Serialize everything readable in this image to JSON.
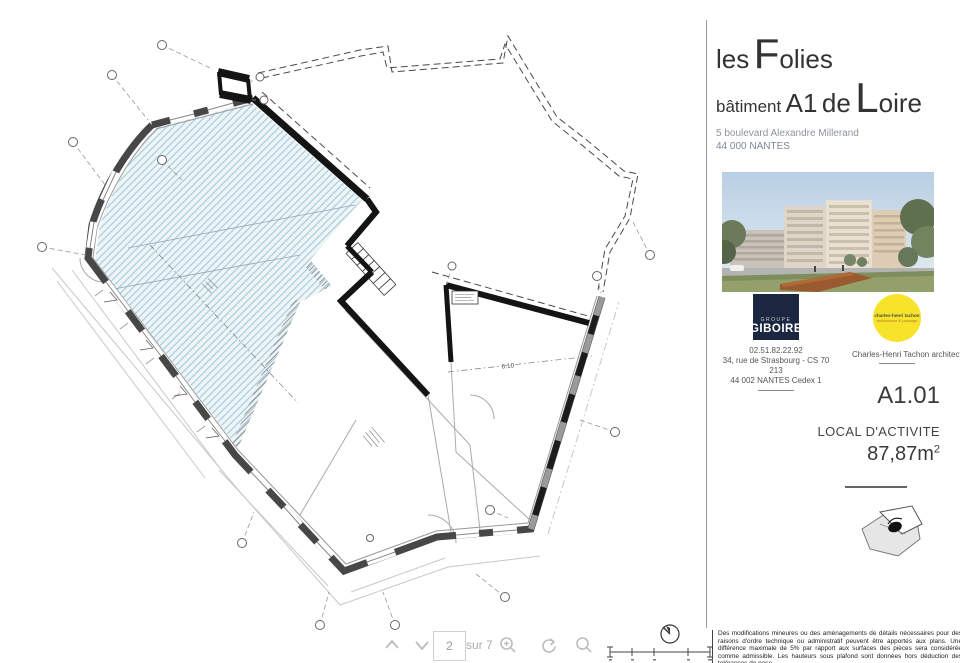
{
  "header": {
    "title_pre": "les",
    "title_big1": "F",
    "title_rest1": "olies",
    "title_bat": "bâtiment",
    "title_unit": "A1",
    "title_de": "de",
    "title_big2": "L",
    "title_rest2": "oire",
    "address_line1": "5 boulevard Alexandre Millerand",
    "address_line2": "44 000 NANTES"
  },
  "developer": {
    "logo_top": "GROUPE",
    "logo_name": "GIBOIRE",
    "phone": "02.51.82.22.92",
    "address1": "34, rue de Strasbourg - CS 70 213",
    "address2": "44 002 NANTES Cedex 1",
    "brand_color": "#1b2740"
  },
  "architect": {
    "circle_line1": "charles-henri tachon",
    "circle_line2": "architecture & paysage",
    "caption": "Charles-Henri Tachon architecte",
    "brand_color": "#f6e32a"
  },
  "plan": {
    "number": "A1.01",
    "room_type": "LOCAL D'ACTIVITE",
    "area_value": "87,87m",
    "area_exponent": "2",
    "room_dimension": "6.10",
    "hatch_color": "#a5c8d8"
  },
  "disclaimer": "Des modifications mineures ou des aménagements de détails nécessaires pour des raisons d'ordre technique ou administratif peuvent être apportés aux plans. Une différence maximale de 5% par rapport aux surfaces des pièces sera considérée comme admissible. Les hauteurs sous plafond sont données hors déduction des tolérances de pose.",
  "viewer": {
    "page_value": "2",
    "pages_label": "sur 7",
    "icons": {
      "page_up": "chevron-up",
      "page_down": "chevron-down",
      "zoom": "magnifier-plus",
      "rotate": "rotate-arrow",
      "search": "magnifier"
    }
  }
}
